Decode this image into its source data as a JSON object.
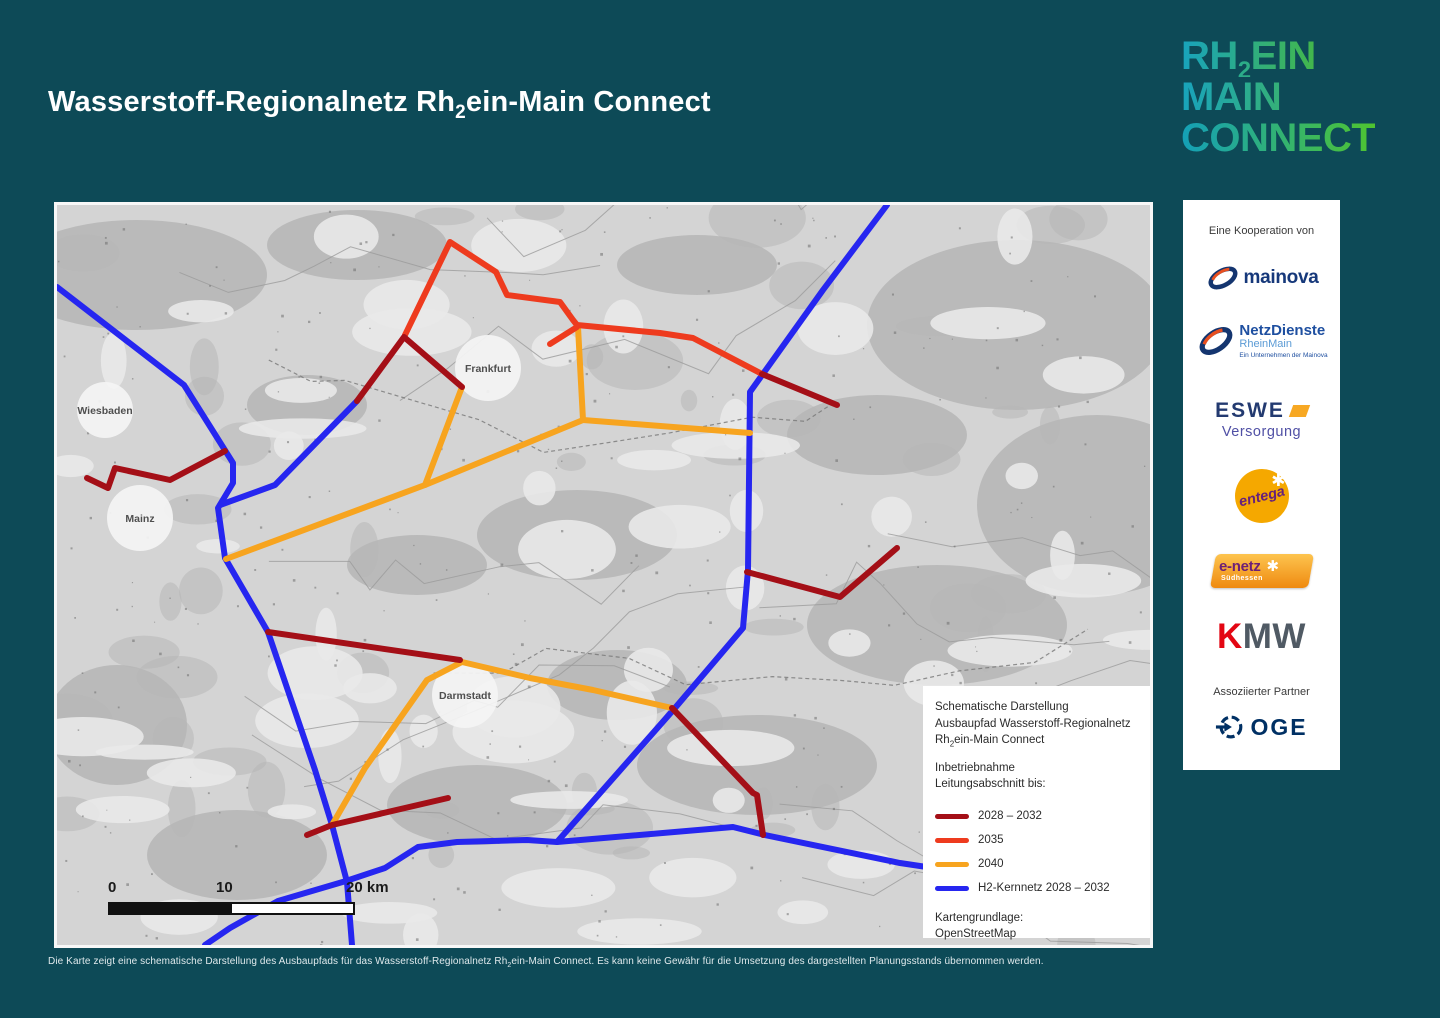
{
  "header": {
    "title_pre": "Wasserstoff-Regionalnetz Rh",
    "title_sub": "2",
    "title_post": "ein-Main Connect"
  },
  "logo": {
    "line1_pre": "RH",
    "line1_sub": "2",
    "line1_post": "EIN",
    "line2": "MAIN",
    "line3": "CONNECT"
  },
  "sidebar": {
    "cooperation_label": "Eine Kooperation von",
    "mainova": "mainova",
    "netzdienste_name": "NetzDienste",
    "netzdienste_sub": "RheinMain",
    "netzdienste_tag": "Ein Unternehmen der Mainova",
    "eswe_name": "ESWE",
    "eswe_sub": "Versorgung",
    "entega": "entega",
    "entega_star": "✱",
    "enetz_name": "e-netz",
    "enetz_star": "✱",
    "enetz_sub": "Südhessen",
    "kmw_k": "K",
    "kmw_mw": "MW",
    "associated_label": "Assoziierter Partner",
    "oge": "OGE"
  },
  "map": {
    "cities": [
      {
        "name": "Wiesbaden",
        "x": 48,
        "y": 205,
        "r": 28
      },
      {
        "name": "Mainz",
        "x": 83,
        "y": 313,
        "r": 33
      },
      {
        "name": "Frankfurt",
        "x": 431,
        "y": 163,
        "r": 33
      },
      {
        "name": "Darmstadt",
        "x": 408,
        "y": 490,
        "r": 33
      }
    ],
    "scalebar": {
      "label0": "0",
      "label10": "10",
      "label20": "20 km"
    },
    "legend": {
      "title_line1": "Schematische Darstellung",
      "title_line2": "Ausbaupfad Wasserstoff-Regionalnetz",
      "title_line3_pre": "Rh",
      "title_line3_sub": "2",
      "title_line3_post": "ein-Main Connect",
      "subtitle_line1": "Inbetriebnahme",
      "subtitle_line2": "Leitungsabschnitt bis:",
      "rows": [
        {
          "key": "y2028",
          "label": "2028 – 2032"
        },
        {
          "key": "y2035",
          "label": "2035"
        },
        {
          "key": "y2040",
          "label": "2040"
        },
        {
          "key": "kern",
          "label": "H2-Kernnetz 2028 – 2032"
        }
      ],
      "source_label": "Kartengrundlage:",
      "source_value": "OpenStreetMap"
    },
    "network": {
      "colors": {
        "kern": "#2626f0",
        "y2040": "#f7a41f",
        "y2035": "#ee3b1e",
        "y2028": "#a40f17"
      },
      "segments": [
        {
          "cat": "kern",
          "pts": [
            [
              0,
              82
            ],
            [
              127,
              180
            ],
            [
              176,
              258
            ],
            [
              176,
              278
            ],
            [
              161,
              303
            ],
            [
              168,
              353
            ],
            [
              211,
              427
            ],
            [
              258,
              565
            ],
            [
              275,
              620
            ],
            [
              290,
              677
            ],
            [
              295,
              740
            ]
          ]
        },
        {
          "cat": "kern",
          "pts": [
            [
              148,
              740
            ],
            [
              173,
              723
            ],
            [
              221,
              696
            ],
            [
              289,
              676
            ],
            [
              328,
              663
            ],
            [
              361,
              642
            ],
            [
              400,
              637
            ],
            [
              470,
              635
            ],
            [
              500,
              637
            ],
            [
              676,
              622
            ],
            [
              708,
              630
            ],
            [
              843,
              658
            ],
            [
              943,
              673
            ],
            [
              1093,
              688
            ]
          ]
        },
        {
          "cat": "kern",
          "pts": [
            [
              830,
              0
            ],
            [
              766,
              85
            ],
            [
              693,
              187
            ],
            [
              691,
              365
            ],
            [
              686,
              423
            ],
            [
              618,
              503
            ],
            [
              500,
              637
            ]
          ]
        },
        {
          "cat": "kern",
          "pts": [
            [
              163,
              300
            ],
            [
              218,
              280
            ],
            [
              300,
              196
            ]
          ]
        },
        {
          "cat": "y2040",
          "pts": [
            [
              169,
              354
            ],
            [
              368,
              280
            ],
            [
              526,
              215
            ]
          ]
        },
        {
          "cat": "y2040",
          "pts": [
            [
              405,
              182
            ],
            [
              368,
              280
            ]
          ]
        },
        {
          "cat": "y2040",
          "pts": [
            [
              521,
              122
            ],
            [
              526,
              215
            ],
            [
              693,
              228
            ]
          ]
        },
        {
          "cat": "y2040",
          "pts": [
            [
              405,
              457
            ],
            [
              370,
              475
            ],
            [
              308,
              563
            ],
            [
              275,
              620
            ]
          ]
        },
        {
          "cat": "y2040",
          "pts": [
            [
              405,
              457
            ],
            [
              473,
              473
            ],
            [
              536,
              485
            ],
            [
              615,
              503
            ]
          ]
        },
        {
          "cat": "y2035",
          "pts": [
            [
              348,
              130
            ],
            [
              393,
              37
            ],
            [
              439,
              67
            ],
            [
              450,
              90
            ],
            [
              503,
              97
            ],
            [
              516,
              115
            ],
            [
              520,
              120
            ],
            [
              603,
              128
            ],
            [
              636,
              133
            ],
            [
              705,
              169
            ]
          ]
        },
        {
          "cat": "y2035",
          "pts": [
            [
              520,
              122
            ],
            [
              493,
              139
            ]
          ]
        },
        {
          "cat": "y2028",
          "pts": [
            [
              30,
              273
            ],
            [
              51,
              283
            ],
            [
              58,
              263
            ],
            [
              113,
              275
            ],
            [
              168,
              246
            ]
          ]
        },
        {
          "cat": "y2028",
          "pts": [
            [
              300,
              196
            ],
            [
              347,
              132
            ],
            [
              405,
              182
            ]
          ]
        },
        {
          "cat": "y2028",
          "pts": [
            [
              705,
              169
            ],
            [
              780,
              200
            ]
          ]
        },
        {
          "cat": "y2028",
          "pts": [
            [
              690,
              367
            ],
            [
              783,
              392
            ],
            [
              840,
              343
            ]
          ]
        },
        {
          "cat": "y2028",
          "pts": [
            [
              211,
              427
            ],
            [
              403,
              455
            ]
          ]
        },
        {
          "cat": "y2028",
          "pts": [
            [
              250,
              630
            ],
            [
              275,
              620
            ],
            [
              391,
              593
            ]
          ]
        },
        {
          "cat": "y2028",
          "pts": [
            [
              615,
              503
            ],
            [
              696,
              588
            ],
            [
              700,
              590
            ],
            [
              706,
              630
            ]
          ]
        }
      ]
    }
  },
  "footer": {
    "disclaimer_pre": "Die Karte zeigt eine schematische Darstellung des Ausbaupfads für das Wasserstoff-Regionalnetz Rh",
    "disclaimer_sub": "2",
    "disclaimer_post": "ein-Main Connect. Es kann keine Gewähr für die Umsetzung des dargestellten Planungsstands übernommen werden."
  }
}
